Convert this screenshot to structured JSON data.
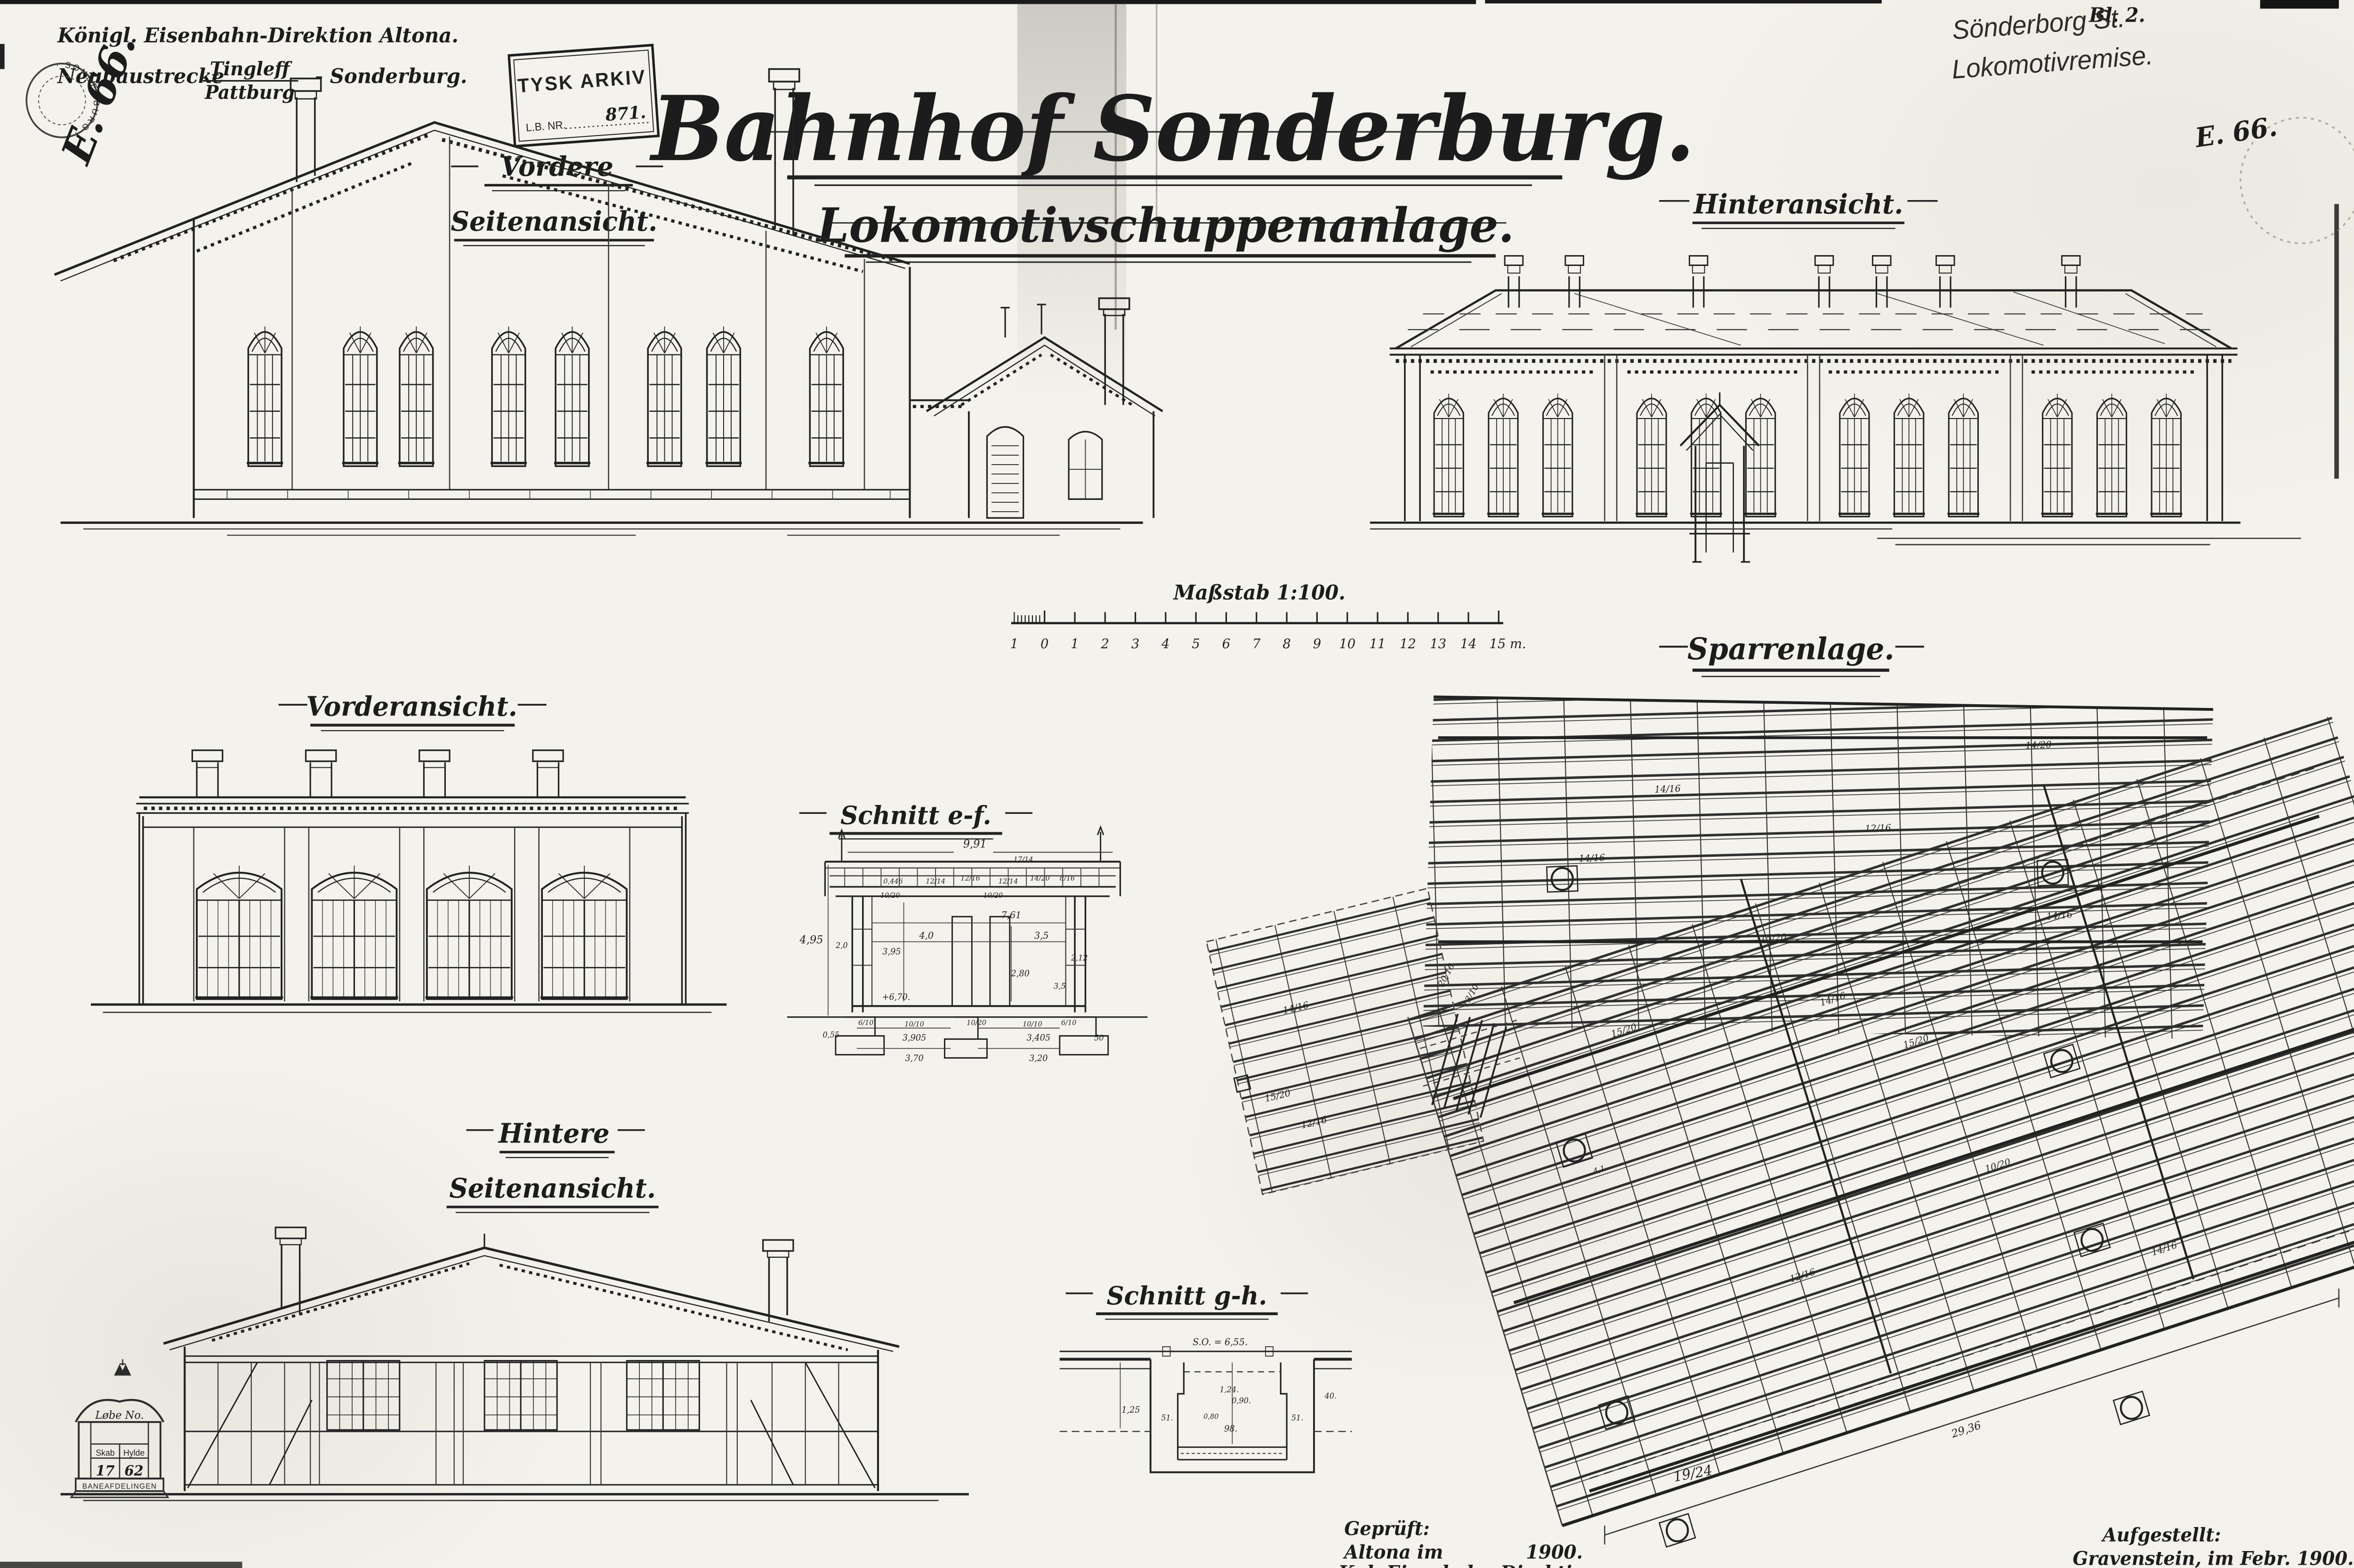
{
  "sheet": {
    "title": "Bahnhof Sonderburg.",
    "subtitle": "Lokomotivschuppenanlage.",
    "sheet_no": "Bl. 2.",
    "file_mark_left": "E. 66.",
    "file_mark_right": "E. 66.",
    "archive_note_line1": "Sönderborg St.",
    "archive_note_line2": "Lokomotivremise."
  },
  "header_block": {
    "line1": "Königl. Eisenbahn-Direktion Altona.",
    "line2_prefix": "Neubaustrecke",
    "route_top": "Tingleff",
    "route_bottom": "Pattburg",
    "line2_suffix": "- Sonderburg."
  },
  "stamps": {
    "tysk_arkiv_line1": "TYSK ARKIV",
    "tysk_arkiv_line2": "L.B. NR.",
    "tysk_arkiv_number": "871.",
    "round_stamp_text": "· SONDERBURG ·",
    "loebe_title": "Løbe No.",
    "loebe_col1": "Skab",
    "loebe_col2": "Hylde",
    "loebe_val1": "17",
    "loebe_val2": "62",
    "loebe_footer": "BANEAFDELINGEN"
  },
  "views": {
    "v1_line1": "Vordere",
    "v1_line2": "Seitenansicht.",
    "v2": "Hinteransicht.",
    "v3": "Vorderansicht.",
    "v4": "Schnitt e-f.",
    "v5": "Sparrenlage.",
    "v6_line1": "Hintere",
    "v6_line2": "Seitenansicht.",
    "v7": "Schnitt g-h."
  },
  "scale_bar": {
    "label": "Maßstab 1:100.",
    "ticks": [
      "1",
      "0",
      "1",
      "2",
      "3",
      "4",
      "5",
      "6",
      "7",
      "8",
      "9",
      "10",
      "11",
      "12",
      "13",
      "14",
      "15 m."
    ]
  },
  "ef_dims": [
    "9,91",
    "4,95",
    "2,0",
    "3,95",
    "7,61",
    "4,0",
    "3,5",
    "3,5",
    "2,80",
    "2,12",
    "+6,70.",
    "6/10",
    "10/10",
    "10/20",
    "10/10",
    "6/10",
    "0,55",
    "3,905",
    "3,405",
    "50",
    "3,70",
    "3,20",
    "0,446",
    "12/14",
    "12/16",
    "12/14",
    "14/20",
    "8/16",
    "10/20",
    "10/20",
    "17/14"
  ],
  "gh_dims": [
    "S.O. = 6,55.",
    "1,24.",
    "0,90.",
    "0,80",
    "98.",
    "51.",
    "51.",
    "1,25",
    "40."
  ],
  "sparren_marks": [
    "14/16",
    "14/20",
    "12/16",
    "14/16",
    "15/20",
    "14/16",
    "15/20",
    "14/16",
    "15/20",
    "10/20",
    "12/16",
    "19/24",
    "14/16",
    "15/20",
    "12/16",
    "14/16",
    "20/16",
    "13/10",
    "4,1",
    "29,36"
  ],
  "footer": {
    "checked_label": "Geprüft:",
    "checked_place": "Altona im",
    "checked_year": "1900.",
    "checked_org": "Kgl. Eisenbahn-Direktion.",
    "prepared_label": "Aufgestellt:",
    "prepared_place": "Gravenstein, im Febr. 1900."
  }
}
